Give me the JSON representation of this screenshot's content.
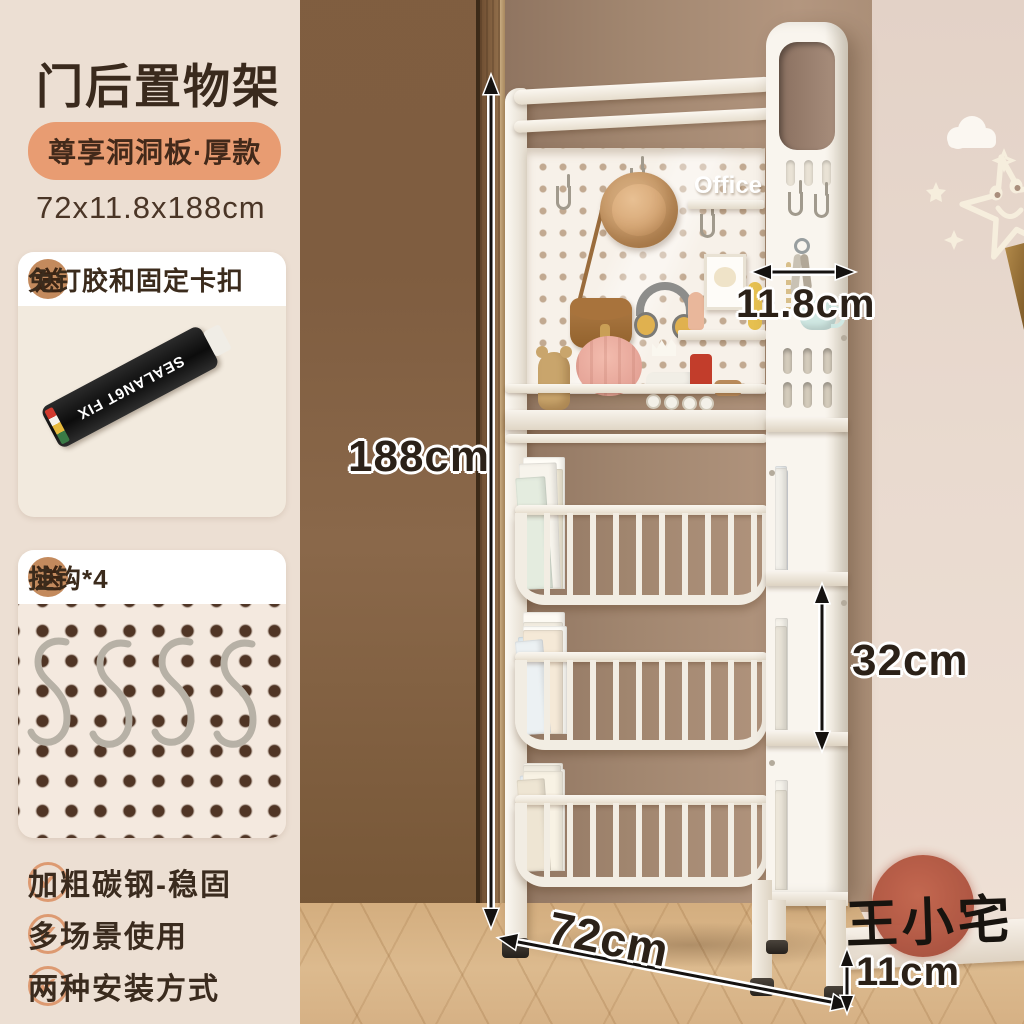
{
  "panel": {
    "title": "门后置物架",
    "subtitle": "尊享洞洞板·厚款",
    "size": "72x11.8x188cm",
    "gift1": {
      "badge": "送",
      "title": "免钉胶和固定卡扣",
      "tube_label": "SEALAN6T FIX"
    },
    "gift2": {
      "badge": "送",
      "title": "挂钩*4"
    },
    "features": [
      "加粗碳钢-稳固",
      "多场景使用",
      "两种安装方式"
    ]
  },
  "dims": {
    "height": "188cm",
    "depth": "11.8cm",
    "tier": "32cm",
    "width": "72cm",
    "foot": "11cm"
  },
  "watermark": "王小宅",
  "decor": {
    "shelf_letters": "Office"
  },
  "icons": {
    "check": "✔"
  },
  "colors": {
    "panel_bg": "#ecdfd3",
    "pill_bg": "#e89c72",
    "badge_bg": "#c38a5d",
    "check": "#dd9a71",
    "stamp": "#b0503c",
    "text_dark": "#3a2a1d",
    "shelf_white": "#f6f1e9",
    "wall_back": "#a1866f",
    "wall_right": "#e8d9cf",
    "door_wood": "#82604a",
    "floor_wood": "#d6b185"
  },
  "baskets": [
    [
      {
        "w": 38,
        "h": 118,
        "c": "#f3ecdb"
      },
      {
        "w": 40,
        "h": 126,
        "c": "#fbf8f1"
      },
      {
        "w": 42,
        "h": 132,
        "c": "#fffdf7"
      },
      {
        "w": 40,
        "h": 120,
        "c": "#f1ead6"
      },
      {
        "w": 38,
        "h": 126,
        "c": "#f7f4ec",
        "r": -2
      },
      {
        "w": 30,
        "h": 112,
        "c": "#e4ecdf",
        "r": -4
      }
    ],
    [
      {
        "w": 42,
        "h": 122,
        "c": "#fdfaf3"
      },
      {
        "w": 40,
        "h": 112,
        "c": "#f3eee2"
      },
      {
        "w": 44,
        "h": 108,
        "c": "#fffef9"
      },
      {
        "w": 36,
        "h": 98,
        "c": "#dde8ee",
        "r": -3
      },
      {
        "w": 40,
        "h": 104,
        "c": "#f5e9d7"
      },
      {
        "w": 28,
        "h": 94,
        "c": "#ecf1f3",
        "r": -5
      }
    ],
    [
      {
        "w": 40,
        "h": 108,
        "c": "#faf5ea"
      },
      {
        "w": 42,
        "h": 102,
        "c": "#fffcf3"
      },
      {
        "w": 38,
        "h": 106,
        "c": "#f0ebdf"
      },
      {
        "w": 36,
        "h": 96,
        "c": "#e6edf1",
        "r": -2
      },
      {
        "w": 40,
        "h": 100,
        "c": "#f8f2e4"
      },
      {
        "w": 28,
        "h": 92,
        "c": "#eee5d3",
        "r": -4
      }
    ]
  ],
  "tower_books": [
    [
      {
        "w": 13,
        "h": 100,
        "c": "#e3e7ea"
      },
      {
        "w": 12,
        "h": 104,
        "c": "#eef1f2"
      },
      {
        "w": 13,
        "h": 98,
        "c": "#dfe3e6"
      },
      {
        "w": 12,
        "h": 102,
        "c": "#f2f0ea"
      }
    ],
    [
      {
        "w": 13,
        "h": 110,
        "c": "#f0ede6"
      },
      {
        "w": 12,
        "h": 106,
        "c": "#e6e9ec"
      },
      {
        "w": 13,
        "h": 112,
        "c": "#f5f2ea"
      },
      {
        "w": 12,
        "h": 104,
        "c": "#e9e4d8"
      }
    ],
    [
      {
        "w": 13,
        "h": 108,
        "c": "#f2eee4"
      },
      {
        "w": 12,
        "h": 104,
        "c": "#e8ebee"
      },
      {
        "w": 13,
        "h": 110,
        "c": "#f6f3ec"
      },
      {
        "w": 12,
        "h": 100,
        "c": "#ece6d9"
      }
    ]
  ]
}
